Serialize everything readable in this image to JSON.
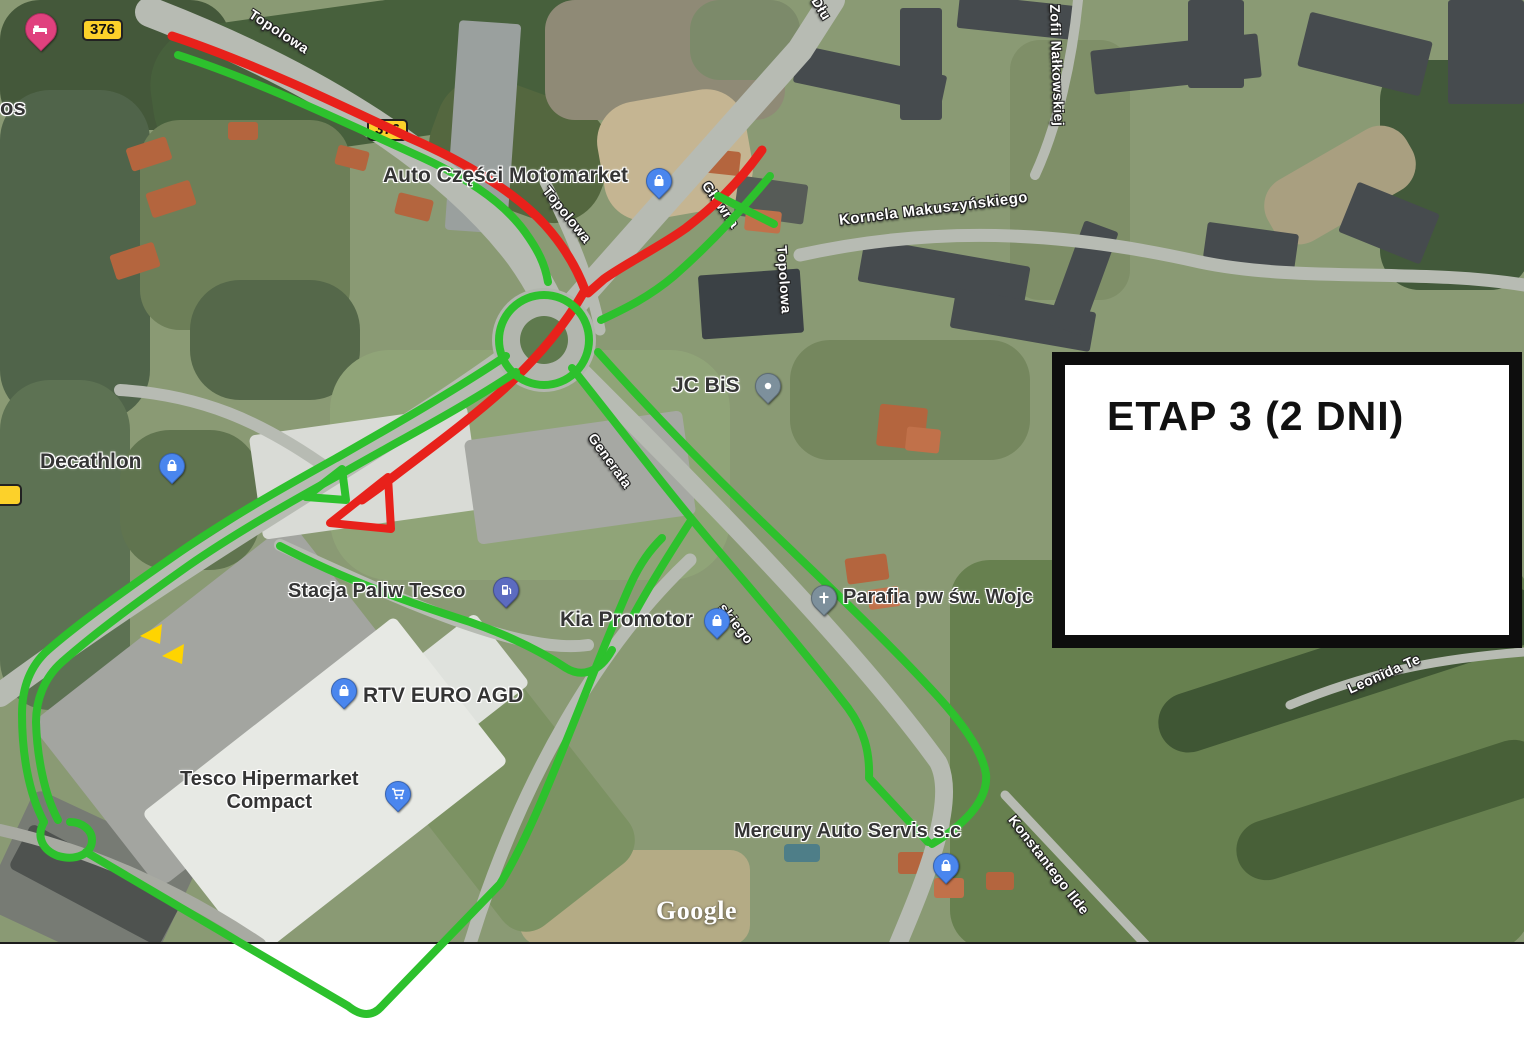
{
  "title_box": {
    "text": "ETAP 3 (2 DNI)"
  },
  "watermark": "Google",
  "colors": {
    "route_green": "#2dc12d",
    "route_red": "#e8211b",
    "shield_yellow": "#fcd12a",
    "box_border": "#0d0d0d",
    "box_bg": "#ffffff"
  },
  "road_shields": [
    {
      "text": "376"
    },
    {
      "text": "376"
    },
    {
      "text": "",
      "note": "clipped shield fragment at left edge"
    }
  ],
  "street_labels": [
    {
      "text": "Topolowa"
    },
    {
      "text": "Topolowa"
    },
    {
      "text": "Topolowa"
    },
    {
      "text": "Kornela Makuszyńskiego"
    },
    {
      "text": "Zofii Nałkowskiej"
    },
    {
      "text": "Główna"
    },
    {
      "text": "Dłu"
    },
    {
      "text": "Generała"
    },
    {
      "text": "skiego"
    },
    {
      "text": "Konstantego Ilde"
    },
    {
      "text": "Leonida Te"
    }
  ],
  "poi_labels": [
    {
      "text": "os"
    },
    {
      "text": "Auto Części Motomarket",
      "marker": "shopping"
    },
    {
      "text": "JC BiS",
      "marker": "generic"
    },
    {
      "text": "Decathlon",
      "marker": "shopping"
    },
    {
      "text": "Stacja Paliw Tesco",
      "marker": "fuel"
    },
    {
      "text": "Kia Promotor",
      "marker": "shopping"
    },
    {
      "text": "RTV EURO AGD",
      "marker": "shopping"
    },
    {
      "lines": [
        "Tesco Hipermarket",
        "Compact"
      ],
      "marker": "cart"
    },
    {
      "text": "Parafia pw św. Wojc",
      "marker": "church"
    },
    {
      "text": "Mercury Auto Servis s.c",
      "marker": "shopping"
    }
  ],
  "standalone_markers": [
    {
      "icon": "lodging-bed-marker"
    }
  ],
  "route_annotations": {
    "green_route_color": "#2dc12d",
    "red_route_color": "#e8211b",
    "detour_arrow_color": "#ffd400",
    "elements": [
      "green double line along north-west road",
      "red line along north-west road",
      "red and green lines on north-east road",
      "green ring on roundabout",
      "red diagonal crossing roundabout ending in red triangle",
      "green triangle at south-west junction",
      "green double line to south-west with hairpin loop",
      "green double line to south-east ending in V at Mercury",
      "green loop around Tesco area extending below map edge",
      "two yellow detour arrows"
    ]
  }
}
